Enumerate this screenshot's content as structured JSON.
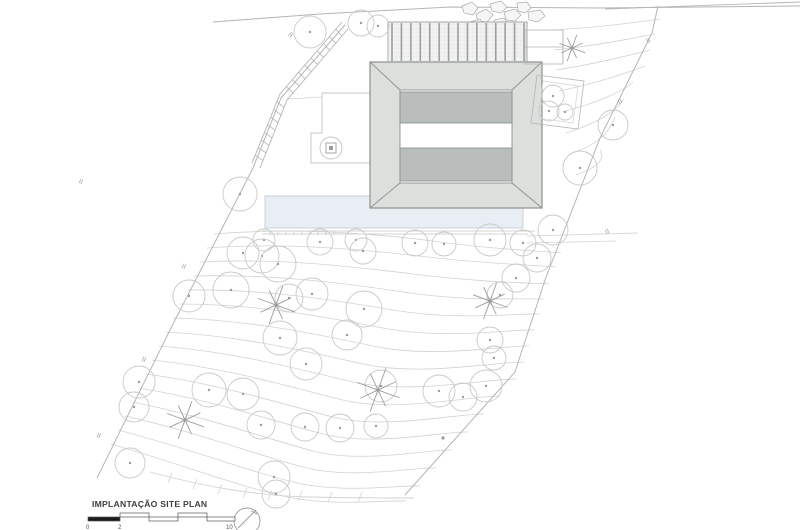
{
  "title_block": {
    "title": "IMPLANTAÇÃO SITE PLAN",
    "scale_labels": [
      "0",
      "2",
      "10"
    ]
  },
  "colors": {
    "contour": "#d2d2d2",
    "boundary": "#b5b5b5",
    "tree": "#c9c9c9",
    "tree_dot": "#9b9b9b",
    "palm": "#9e9e9e",
    "rock": "#adadad",
    "rock_fill": "#f6f6f6",
    "roof_fill": "#dcdfdc",
    "roof_stroke": "#8d928e",
    "band_fill": "#b9bdbb",
    "band_stroke": "#878c89",
    "deck_fill": "#f1f2f1",
    "deck_slat": "#9ba09b",
    "deck_grid": "#dcdcdc",
    "pool_fill": "#e9eef5",
    "pool_stroke": "#c9d0da",
    "hardscape": "#c4c4c4",
    "mark": "#ababab",
    "scale_dark": "#1a1a1a",
    "scale_stroke": "#555555",
    "label": "#555555",
    "north": "#9a9a9a"
  },
  "plan": {
    "pool": {
      "x": 265,
      "y": 196,
      "w": 258,
      "h": 32,
      "deck_lines": [
        [
          262,
          231,
          535,
          231
        ],
        [
          262,
          234,
          528,
          234
        ]
      ],
      "tick_y": 231,
      "tick_h": 4,
      "tick_x0": 270,
      "tick_dx": 8,
      "tick_n": 9
    },
    "contours": [
      "M214,234 C300,227 380,234 440,242 S542,251 561,253",
      "M207,248 C288,242 368,250 428,257 S536,265 556,267",
      "M200,262 C278,258 348,266 413,274 S528,283 549,284",
      "M194,276 C268,274 338,282 403,292 S522,298 544,299",
      "M187,290 C262,289 328,299 393,310 S518,313 540,314",
      "M180,304 C255,304 320,316 383,328 S512,329 534,330",
      "M173,318 C248,320 312,333 373,346 S508,345 529,346",
      "M166,332 C242,336 305,351 363,364 S502,361 524,362",
      "M159,346 C235,352 298,369 353,382 S494,378 516,379",
      "M152,360 C228,368 290,387 343,400 S478,395 500,396",
      "M146,374 C220,384 282,404 333,417 S462,413 484,414",
      "M139,388 C212,400 273,421 323,434 S446,431 468,432",
      "M132,402 C204,416 264,438 313,451 S430,449 452,450",
      "M125,416 C196,432 254,454 303,467 S414,467 436,468",
      "M118,430 C188,448 244,470 293,482 S398,485 420,486",
      "M111,444 C180,464 235,485 283,496 S384,500 406,501"
    ],
    "fan_lines": [
      "M552,30 C590,28 625,24 660,19",
      "M554,50 C592,46 625,40 655,34",
      "M556,70 C595,64 627,56 650,50",
      "M559,91 C598,83 626,73 645,66",
      "M562,112 C600,102 623,91 633,82",
      "M566,133 C598,123 615,112 624,99",
      "M570,154 C596,145 608,135 615,117",
      "M576,175 C596,168 606,160 600,150"
    ],
    "misc_lines": [
      [
        527,
        236,
        638,
        233
      ],
      [
        527,
        243,
        616,
        241
      ],
      [
        287,
        99,
        322,
        97
      ]
    ],
    "fence": {
      "d": "M150,472 C210,488 260,496 310,497 S390,498 414,498",
      "ticks": [
        [
          170,
          478
        ],
        [
          195,
          484
        ],
        [
          220,
          489
        ],
        [
          245,
          493
        ],
        [
          270,
          495
        ],
        [
          300,
          496
        ],
        [
          330,
          497
        ],
        [
          360,
          497
        ]
      ]
    },
    "boundaries": {
      "top_road": [
        [
          213,
          22
        ],
        [
          320,
          14
        ],
        [
          450,
          7
        ],
        [
          600,
          8
        ],
        [
          800,
          6
        ]
      ],
      "top_road2": [
        [
          605,
          9
        ],
        [
          800,
          2
        ]
      ],
      "right": [
        [
          658,
          6
        ],
        [
          652,
          33
        ],
        [
          600,
          138
        ],
        [
          545,
          280
        ],
        [
          515,
          372
        ],
        [
          405,
          495
        ]
      ],
      "left": [
        [
          345,
          25
        ],
        [
          281,
          98
        ],
        [
          253,
          168
        ],
        [
          170,
          330
        ],
        [
          97,
          478
        ]
      ]
    },
    "stairs": {
      "rail_a": [
        [
          348,
          29
        ],
        [
          287,
          100
        ],
        [
          260,
          168
        ]
      ],
      "rail_b": [
        [
          342,
          22
        ],
        [
          280,
          94
        ],
        [
          252,
          163
        ]
      ],
      "rungs_per_seg": [
        9,
        8
      ]
    },
    "marks": [
      {
        "x": 80,
        "y": 181,
        "a": -65
      },
      {
        "x": 183,
        "y": 266,
        "a": -65
      },
      {
        "x": 143,
        "y": 359,
        "a": -66
      },
      {
        "x": 98,
        "y": 435,
        "a": -66
      },
      {
        "x": 290,
        "y": 34,
        "a": -50
      },
      {
        "x": 649,
        "y": 40,
        "a": 62
      },
      {
        "x": 621,
        "y": 101,
        "a": 63
      },
      {
        "x": 608,
        "y": 231,
        "a": 64
      }
    ],
    "dot_mark": {
      "x": 443,
      "y": 438,
      "a": 60
    },
    "rocks": [
      [
        [
          462,
          6
        ],
        [
          472,
          2
        ],
        [
          478,
          8
        ],
        [
          473,
          15
        ],
        [
          464,
          13
        ]
      ],
      [
        [
          476,
          14
        ],
        [
          486,
          9
        ],
        [
          493,
          15
        ],
        [
          487,
          22
        ],
        [
          478,
          21
        ]
      ],
      [
        [
          490,
          4
        ],
        [
          501,
          1
        ],
        [
          507,
          7
        ],
        [
          501,
          13
        ],
        [
          492,
          11
        ]
      ],
      [
        [
          504,
          12
        ],
        [
          515,
          9
        ],
        [
          521,
          15
        ],
        [
          515,
          21
        ],
        [
          506,
          20
        ]
      ],
      [
        [
          517,
          3
        ],
        [
          527,
          2
        ],
        [
          531,
          8
        ],
        [
          525,
          13
        ],
        [
          518,
          11
        ]
      ],
      [
        [
          470,
          22
        ],
        [
          480,
          19
        ],
        [
          484,
          25
        ],
        [
          477,
          29
        ],
        [
          470,
          27
        ]
      ],
      [
        [
          494,
          20
        ],
        [
          504,
          18
        ],
        [
          509,
          24
        ],
        [
          502,
          29
        ],
        [
          495,
          27
        ]
      ],
      [
        [
          528,
          12
        ],
        [
          540,
          10
        ],
        [
          545,
          16
        ],
        [
          538,
          22
        ],
        [
          529,
          20
        ]
      ]
    ],
    "terrace_left": [
      [
        370,
        93
      ],
      [
        322,
        93
      ],
      [
        322,
        133
      ],
      [
        311,
        133
      ],
      [
        311,
        163
      ],
      [
        370,
        163
      ]
    ],
    "circle_square": {
      "cx": 331,
      "cy": 148,
      "r": 11
    },
    "building": {
      "deck": {
        "x": 388,
        "y": 22,
        "w": 139,
        "h": 40,
        "slat_n": 15,
        "slat_dx": 9.43
      },
      "roof_outer": {
        "x": 370,
        "y": 62,
        "w": 172,
        "h": 146
      },
      "roof_inner": {
        "x": 400,
        "y": 90,
        "w": 112,
        "h": 93
      },
      "band_top": {
        "x": 400,
        "y": 92,
        "w": 112,
        "h": 31
      },
      "band_bottom": {
        "x": 400,
        "y": 148,
        "w": 112,
        "h": 33
      }
    },
    "right_structures": {
      "rect": {
        "x": 525,
        "y": 30,
        "w": 38,
        "h": 34
      },
      "lines": [
        [
          563,
          30,
          563,
          64
        ],
        [
          525,
          47,
          563,
          47
        ]
      ],
      "planter_outer": [
        [
          537,
          75
        ],
        [
          584,
          81
        ],
        [
          578,
          129
        ],
        [
          531,
          123
        ]
      ],
      "planter_inner": [
        [
          543,
          81
        ],
        [
          578,
          86
        ],
        [
          573,
          123
        ],
        [
          538,
          118
        ]
      ]
    },
    "trees": [
      [
        310,
        32,
        16
      ],
      [
        361,
        23,
        13
      ],
      [
        378,
        26,
        11
      ],
      [
        553,
        96,
        11
      ],
      [
        549,
        111,
        10
      ],
      [
        565,
        112,
        8
      ],
      [
        613,
        125,
        15
      ],
      [
        580,
        168,
        17
      ],
      [
        240,
        194,
        17
      ],
      [
        264,
        240,
        11
      ],
      [
        243,
        253,
        16
      ],
      [
        262,
        256,
        17
      ],
      [
        278,
        264,
        18
      ],
      [
        320,
        242,
        13
      ],
      [
        356,
        240,
        11
      ],
      [
        363,
        251,
        13
      ],
      [
        415,
        243,
        13
      ],
      [
        444,
        244,
        12
      ],
      [
        490,
        240,
        16
      ],
      [
        523,
        243,
        13
      ],
      [
        553,
        230,
        15
      ],
      [
        537,
        258,
        14
      ],
      [
        516,
        278,
        14
      ],
      [
        500,
        295,
        13
      ],
      [
        231,
        290,
        18
      ],
      [
        189,
        296,
        16
      ],
      [
        289,
        298,
        14
      ],
      [
        312,
        294,
        16
      ],
      [
        364,
        309,
        18
      ],
      [
        347,
        335,
        15
      ],
      [
        280,
        338,
        17
      ],
      [
        306,
        364,
        16
      ],
      [
        381,
        386,
        16
      ],
      [
        439,
        391,
        16
      ],
      [
        463,
        397,
        14
      ],
      [
        486,
        386,
        16
      ],
      [
        494,
        358,
        12
      ],
      [
        490,
        340,
        13
      ],
      [
        139,
        382,
        16
      ],
      [
        134,
        407,
        15
      ],
      [
        209,
        390,
        17
      ],
      [
        243,
        394,
        16
      ],
      [
        130,
        463,
        15
      ],
      [
        261,
        425,
        14
      ],
      [
        274,
        477,
        16
      ],
      [
        276,
        494,
        14
      ],
      [
        305,
        427,
        14
      ],
      [
        340,
        428,
        14
      ],
      [
        376,
        426,
        12
      ]
    ],
    "palms": [
      [
        572,
        48,
        14
      ],
      [
        276,
        305,
        20
      ],
      [
        378,
        390,
        23
      ],
      [
        490,
        301,
        19
      ],
      [
        185,
        420,
        20
      ]
    ],
    "north_arrow": {
      "cx": 247,
      "cy": 521,
      "r": 13
    },
    "scale_bar": {
      "segments": [
        {
          "x": 88,
          "y": 517,
          "w": 32,
          "h": 4,
          "solid": true
        },
        {
          "x": 120,
          "y": 513,
          "w": 29,
          "h": 4,
          "solid": false
        },
        {
          "x": 149,
          "y": 517,
          "w": 29,
          "h": 4,
          "solid": false
        },
        {
          "x": 178,
          "y": 513,
          "w": 29,
          "h": 4,
          "solid": false
        },
        {
          "x": 207,
          "y": 517,
          "w": 28,
          "h": 4,
          "solid": false
        }
      ],
      "label_pos": [
        [
          86,
          529
        ],
        [
          118,
          529
        ],
        [
          226,
          529
        ]
      ]
    }
  }
}
